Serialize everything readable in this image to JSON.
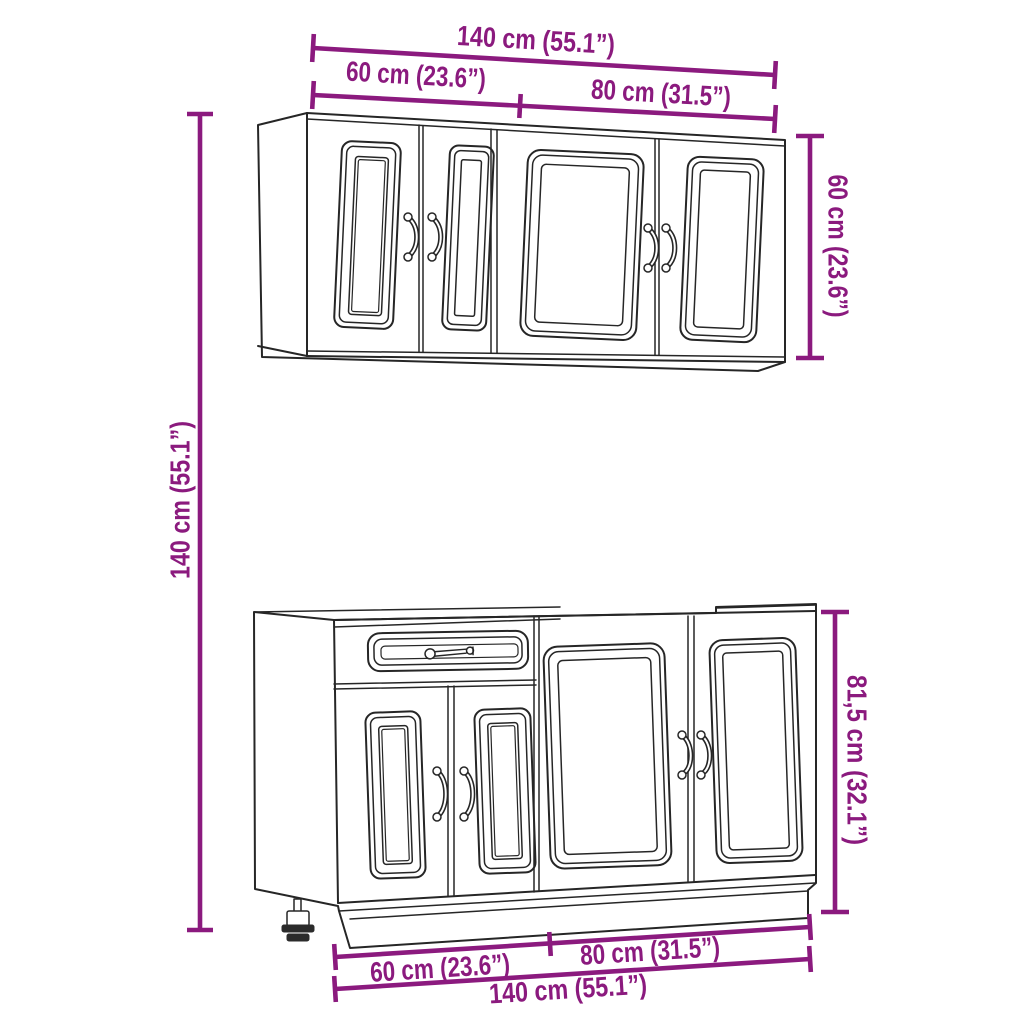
{
  "colors": {
    "dimension": "#8B1A7E",
    "outline": "#262626",
    "background": "#ffffff"
  },
  "dimensions": {
    "wall_unit": {
      "total_width": "140 cm (55.1”)",
      "left_section_width": "60 cm (23.6”)",
      "right_section_width": "80 cm (31.5”)",
      "height": "60 cm (23.6”)"
    },
    "overall": {
      "total_height": "140 cm (55.1”)"
    },
    "base_unit": {
      "height": "81,5 cm (32.1”)",
      "left_section_width": "60 cm (23.6”)",
      "right_section_width": "80 cm (31.5”)",
      "total_width": "140 cm (55.1”)"
    }
  }
}
